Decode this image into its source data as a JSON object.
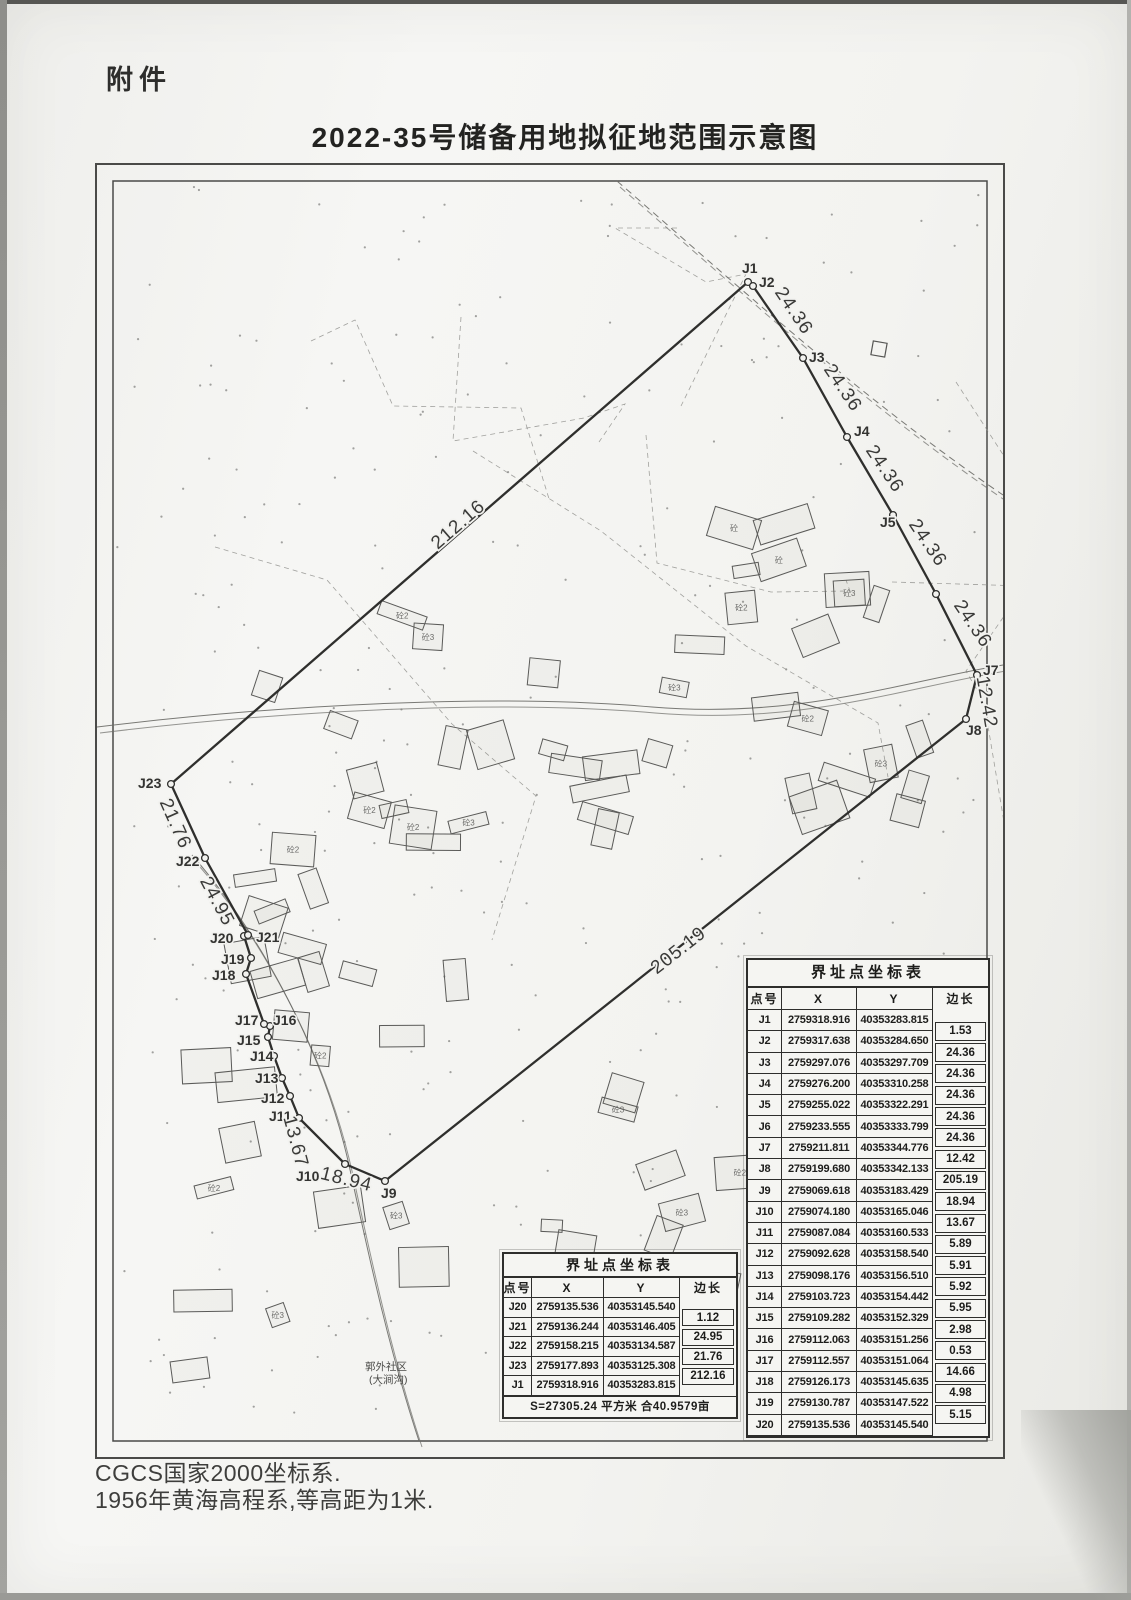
{
  "page": {
    "attachment_label": "附件",
    "title": "2022-35号储备用地拟征地范围示意图",
    "footer_line1": "CGCS国家2000坐标系.",
    "footer_line2": "1956年黄海高程系,等高距为1米."
  },
  "map": {
    "village_label_line1": "郭外社区",
    "village_label_line2": "(大涧沟)",
    "building_marks": [
      "砼2",
      "砼3",
      "砼"
    ],
    "boundary_points": [
      {
        "id": "J1",
        "x": 651,
        "y": 117
      },
      {
        "id": "J2",
        "x": 656,
        "y": 121
      },
      {
        "id": "J3",
        "x": 706,
        "y": 193
      },
      {
        "id": "J4",
        "x": 750,
        "y": 272
      },
      {
        "id": "J5",
        "x": 796,
        "y": 350
      },
      {
        "id": "J6",
        "x": 839,
        "y": 429
      },
      {
        "id": "J7",
        "x": 880,
        "y": 510
      },
      {
        "id": "J8",
        "x": 869,
        "y": 554
      },
      {
        "id": "J9",
        "x": 288,
        "y": 1016
      },
      {
        "id": "J10",
        "x": 248,
        "y": 999
      },
      {
        "id": "J11",
        "x": 202,
        "y": 953
      },
      {
        "id": "J12",
        "x": 193,
        "y": 931
      },
      {
        "id": "J13",
        "x": 185,
        "y": 913
      },
      {
        "id": "J14",
        "x": 177,
        "y": 891
      },
      {
        "id": "J15",
        "x": 171,
        "y": 872
      },
      {
        "id": "J16",
        "x": 173,
        "y": 861
      },
      {
        "id": "J17",
        "x": 167,
        "y": 859
      },
      {
        "id": "J18",
        "x": 149,
        "y": 809
      },
      {
        "id": "J19",
        "x": 154,
        "y": 793
      },
      {
        "id": "J20",
        "x": 147,
        "y": 771
      },
      {
        "id": "J21",
        "x": 151,
        "y": 770
      },
      {
        "id": "J22",
        "x": 108,
        "y": 693
      },
      {
        "id": "J23",
        "x": 74,
        "y": 619
      }
    ],
    "point_labels": [
      {
        "text": "J1",
        "x": 645,
        "y": 108
      },
      {
        "text": "J2",
        "x": 662,
        "y": 122
      },
      {
        "text": "J3",
        "x": 712,
        "y": 197
      },
      {
        "text": "J4",
        "x": 757,
        "y": 271
      },
      {
        "text": "J5",
        "x": 783,
        "y": 362
      },
      {
        "text": "J7",
        "x": 886,
        "y": 510
      },
      {
        "text": "J8",
        "x": 869,
        "y": 570
      },
      {
        "text": "J9",
        "x": 284,
        "y": 1033
      },
      {
        "text": "J10",
        "x": 199,
        "y": 1016
      },
      {
        "text": "J11",
        "x": 172,
        "y": 956
      },
      {
        "text": "J12",
        "x": 164,
        "y": 938
      },
      {
        "text": "J13",
        "x": 158,
        "y": 918
      },
      {
        "text": "J14",
        "x": 153,
        "y": 896
      },
      {
        "text": "J15",
        "x": 140,
        "y": 880
      },
      {
        "text": "J16",
        "x": 176,
        "y": 860
      },
      {
        "text": "J17",
        "x": 138,
        "y": 860
      },
      {
        "text": "J18",
        "x": 115,
        "y": 815
      },
      {
        "text": "J19",
        "x": 124,
        "y": 799
      },
      {
        "text": "J20",
        "x": 113,
        "y": 778
      },
      {
        "text": "J21",
        "x": 159,
        "y": 777
      },
      {
        "text": "J22",
        "x": 79,
        "y": 701
      },
      {
        "text": "J23",
        "x": 41,
        "y": 623
      }
    ],
    "edge_labels": [
      {
        "text": "212.16",
        "x": 365,
        "y": 364,
        "rot": -41
      },
      {
        "text": "24.36",
        "x": 692,
        "y": 149,
        "rot": 56
      },
      {
        "text": "24.36",
        "x": 741,
        "y": 226,
        "rot": 56
      },
      {
        "text": "24.36",
        "x": 783,
        "y": 307,
        "rot": 56
      },
      {
        "text": "24.36",
        "x": 826,
        "y": 381,
        "rot": 56
      },
      {
        "text": "24.36",
        "x": 871,
        "y": 462,
        "rot": 56
      },
      {
        "text": "12.42",
        "x": 884,
        "y": 538,
        "rot": 80
      },
      {
        "text": "205.19",
        "x": 585,
        "y": 790,
        "rot": -38
      },
      {
        "text": "18.94",
        "x": 248,
        "y": 1020,
        "rot": 14
      },
      {
        "text": "13.67",
        "x": 193,
        "y": 978,
        "rot": 75
      },
      {
        "text": "24.95",
        "x": 115,
        "y": 739,
        "rot": 62
      },
      {
        "text": "21.76",
        "x": 73,
        "y": 661,
        "rot": 66
      }
    ]
  },
  "table_main": {
    "title": "界址点坐标表",
    "columns": [
      "点号",
      "X",
      "Y",
      "边长"
    ],
    "rows": [
      {
        "id": "J1",
        "x": "2759318.916",
        "y": "40353283.815"
      },
      {
        "id": "J2",
        "x": "2759317.638",
        "y": "40353284.650"
      },
      {
        "id": "J3",
        "x": "2759297.076",
        "y": "40353297.709"
      },
      {
        "id": "J4",
        "x": "2759276.200",
        "y": "40353310.258"
      },
      {
        "id": "J5",
        "x": "2759255.022",
        "y": "40353322.291"
      },
      {
        "id": "J6",
        "x": "2759233.555",
        "y": "40353333.799"
      },
      {
        "id": "J7",
        "x": "2759211.811",
        "y": "40353344.776"
      },
      {
        "id": "J8",
        "x": "2759199.680",
        "y": "40353342.133"
      },
      {
        "id": "J9",
        "x": "2759069.618",
        "y": "40353183.429"
      },
      {
        "id": "J10",
        "x": "2759074.180",
        "y": "40353165.046"
      },
      {
        "id": "J11",
        "x": "2759087.084",
        "y": "40353160.533"
      },
      {
        "id": "J12",
        "x": "2759092.628",
        "y": "40353158.540"
      },
      {
        "id": "J13",
        "x": "2759098.176",
        "y": "40353156.510"
      },
      {
        "id": "J14",
        "x": "2759103.723",
        "y": "40353154.442"
      },
      {
        "id": "J15",
        "x": "2759109.282",
        "y": "40353152.329"
      },
      {
        "id": "J16",
        "x": "2759112.063",
        "y": "40353151.256"
      },
      {
        "id": "J17",
        "x": "2759112.557",
        "y": "40353151.064"
      },
      {
        "id": "J18",
        "x": "2759126.173",
        "y": "40353145.635"
      },
      {
        "id": "J19",
        "x": "2759130.787",
        "y": "40353147.522"
      },
      {
        "id": "J20",
        "x": "2759135.536",
        "y": "40353145.540"
      }
    ],
    "side_lengths": [
      "1.53",
      "24.36",
      "24.36",
      "24.36",
      "24.36",
      "24.36",
      "12.42",
      "205.19",
      "18.94",
      "13.67",
      "5.89",
      "5.91",
      "5.92",
      "5.95",
      "2.98",
      "0.53",
      "14.66",
      "4.98",
      "5.15"
    ]
  },
  "table_small": {
    "title": "界址点坐标表",
    "columns": [
      "点号",
      "X",
      "Y",
      "边长"
    ],
    "rows": [
      {
        "id": "J20",
        "x": "2759135.536",
        "y": "40353145.540"
      },
      {
        "id": "J21",
        "x": "2759136.244",
        "y": "40353146.405"
      },
      {
        "id": "J22",
        "x": "2759158.215",
        "y": "40353134.587"
      },
      {
        "id": "J23",
        "x": "2759177.893",
        "y": "40353125.308"
      },
      {
        "id": "J1",
        "x": "2759318.916",
        "y": "40353283.815"
      }
    ],
    "side_lengths": [
      "1.12",
      "24.95",
      "21.76",
      "212.16"
    ],
    "area_note": "S=27305.24 平方米 合40.9579亩"
  }
}
